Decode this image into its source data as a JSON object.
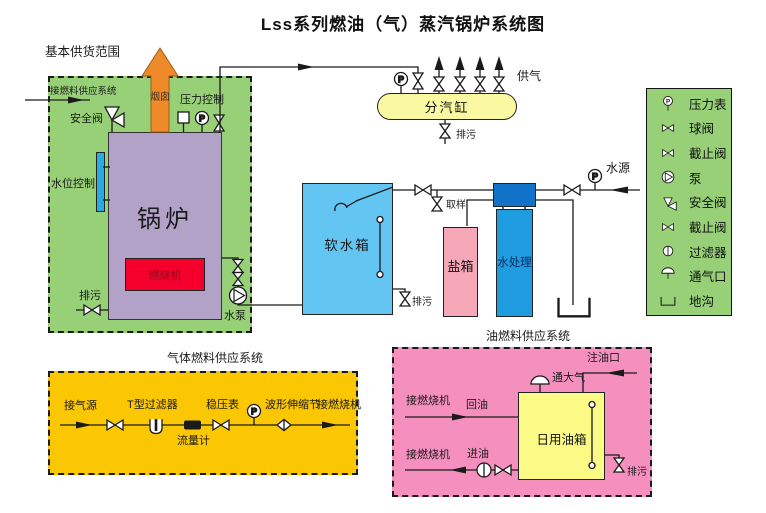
{
  "title": "Lss系列燃油（气）蒸汽锅炉系统图",
  "letters": {
    "p": "P"
  },
  "colors": {
    "green": "#97D077",
    "gas-yellow": "#FBC602",
    "oil-pink": "#F590BE",
    "boiler-purple": "#B3A2C7",
    "burner-red": "#F5002D",
    "level-blue": "#29AAE3",
    "soft-blue": "#63C6F2",
    "salt-pink": "#F7A8B8",
    "treat-blue": "#1F9CE0",
    "treat-header": "#1173C8",
    "cylinder-yellow": "#FAF9A2",
    "tank-yellow": "#FAFA85",
    "chimney-orange": "#EE8A2A",
    "line": "#1a1a1a"
  },
  "main": {
    "scope": "基本供货范围",
    "fuel_inlet": "接燃料供应系统",
    "safety_valve": "安全阀",
    "chimney": "烟囱",
    "pressure_control": "压力控制",
    "water_level": "水位控制",
    "boiler": "锅炉",
    "burner": "燃烧机",
    "blowdown": "排污",
    "pump": "水泵"
  },
  "steam": {
    "cylinder": "分汽缸",
    "supply": "供气",
    "blowdown": "排污"
  },
  "water": {
    "soft_tank": "软水箱",
    "sampling": "取样",
    "salt_tank": "盐箱",
    "treatment": "水处理",
    "source": "水源",
    "blowdown": "排污"
  },
  "legend": {
    "items": [
      {
        "icon": "pressure-gauge",
        "label": "压力表"
      },
      {
        "icon": "ball-valve",
        "label": "球阀"
      },
      {
        "icon": "stop-valve",
        "label": "截止阀"
      },
      {
        "icon": "pump",
        "label": "泵"
      },
      {
        "icon": "safety-valve",
        "label": "安全阀"
      },
      {
        "icon": "stop-valve",
        "label": "截止阀"
      },
      {
        "icon": "filter",
        "label": "过滤器"
      },
      {
        "icon": "vent",
        "label": "通气口"
      },
      {
        "icon": "trench",
        "label": "地沟"
      }
    ]
  },
  "gas": {
    "title": "气体燃料供应系统",
    "source": "接气源",
    "filter": "T型过滤器",
    "flow_meter": "流量计",
    "regulator": "稳压表",
    "expansion": "波形伸缩节",
    "to_burner": "接燃烧机"
  },
  "oil": {
    "title": "油燃料供应系统",
    "fill_port": "注油口",
    "vent": "通大气",
    "to_burner_return": "接燃烧机",
    "return": "回油",
    "to_burner_inlet": "接燃烧机",
    "inlet": "进油",
    "tank": "日用油箱",
    "blowdown": "排污"
  }
}
